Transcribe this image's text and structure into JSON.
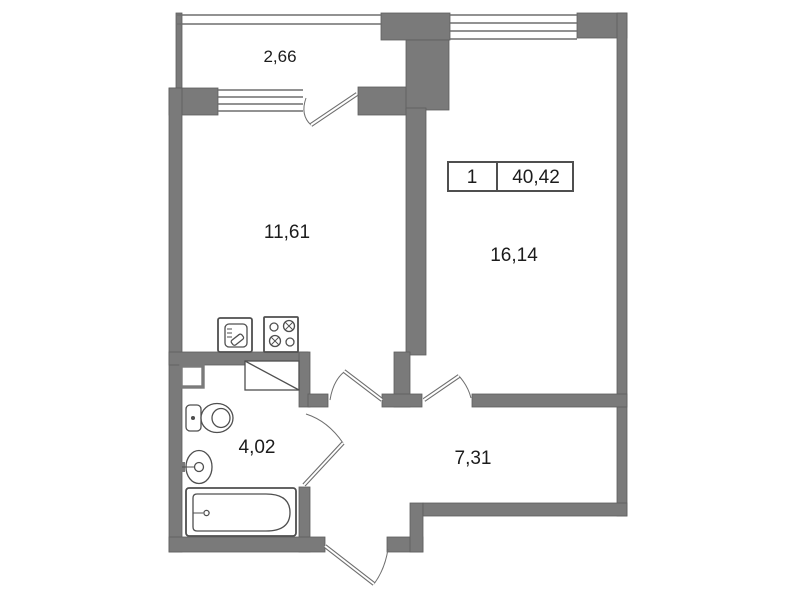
{
  "floor_plan": {
    "unit_box": {
      "number": "1",
      "total_area": "40,42"
    },
    "rooms": [
      {
        "id": "balcony",
        "area": "2,66"
      },
      {
        "id": "kitchen",
        "area": "11,61"
      },
      {
        "id": "living-room",
        "area": "16,14"
      },
      {
        "id": "bathroom",
        "area": "4,02"
      },
      {
        "id": "hallway",
        "area": "7,31"
      }
    ],
    "fixtures": [
      "kitchen-sink",
      "stove",
      "wardrobe",
      "vent-duct",
      "toilet",
      "washbasin",
      "bathtub"
    ],
    "colors": {
      "wall": "#7a7a7a",
      "wall_edge": "#5e5e5e",
      "line": "#6e6e6e",
      "fixture": "#4f4f4f",
      "text": "#1c1c1c",
      "background": "#ffffff"
    }
  }
}
